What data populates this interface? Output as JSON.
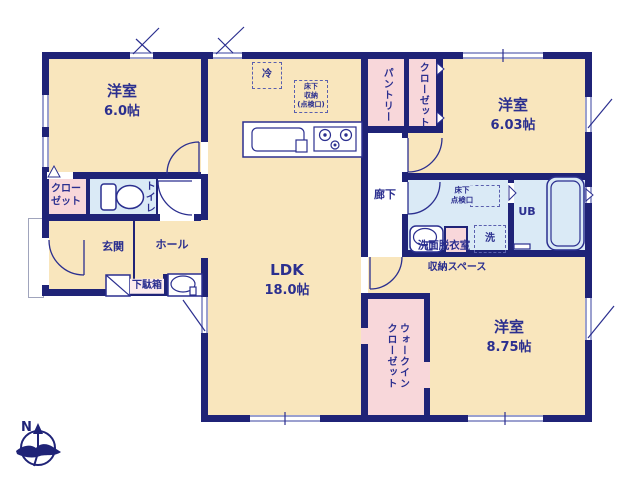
{
  "colors": {
    "wall": "#1f2377",
    "text": "#2b2f8f",
    "room_fill": "#f9e6bd",
    "storage_fill": "#f8d7da",
    "wet_area_fill": "#daeaf6",
    "window_line": "#9ba0cf"
  },
  "rooms": {
    "bedroom1": {
      "name": "洋室",
      "size": "6.0帖"
    },
    "bedroom2": {
      "name": "洋室",
      "size": "6.03帖"
    },
    "bedroom3": {
      "name": "洋室",
      "size": "8.75帖"
    },
    "ldk": {
      "name": "LDK",
      "size": "18.0帖"
    },
    "closet1": {
      "line1": "クロー",
      "line2": "ゼット"
    },
    "toilet": {
      "name": "トイレ"
    },
    "genkan": {
      "name": "玄関"
    },
    "hall": {
      "name": "ホール"
    },
    "shoebox": {
      "name": "下駄箱"
    },
    "corridor": {
      "name": "廊下"
    },
    "pantry": {
      "name": "パントリー"
    },
    "closet2": {
      "name": "クローゼット"
    },
    "washroom": {
      "name": "洗面脱衣室"
    },
    "laundry": {
      "name": "洗"
    },
    "bath": {
      "name": "UB"
    },
    "storage_space": {
      "name": "収納スペース"
    },
    "wic": {
      "line1": "ウォークイン",
      "line2": "クローゼット"
    },
    "fridge": {
      "name": "冷"
    },
    "underfloor_kitchen": {
      "line1": "床下",
      "line2": "収納",
      "line3": "(点検口)"
    },
    "underfloor_wash": {
      "line1": "床下",
      "line2": "点検口"
    }
  },
  "compass": {
    "north": "N"
  }
}
